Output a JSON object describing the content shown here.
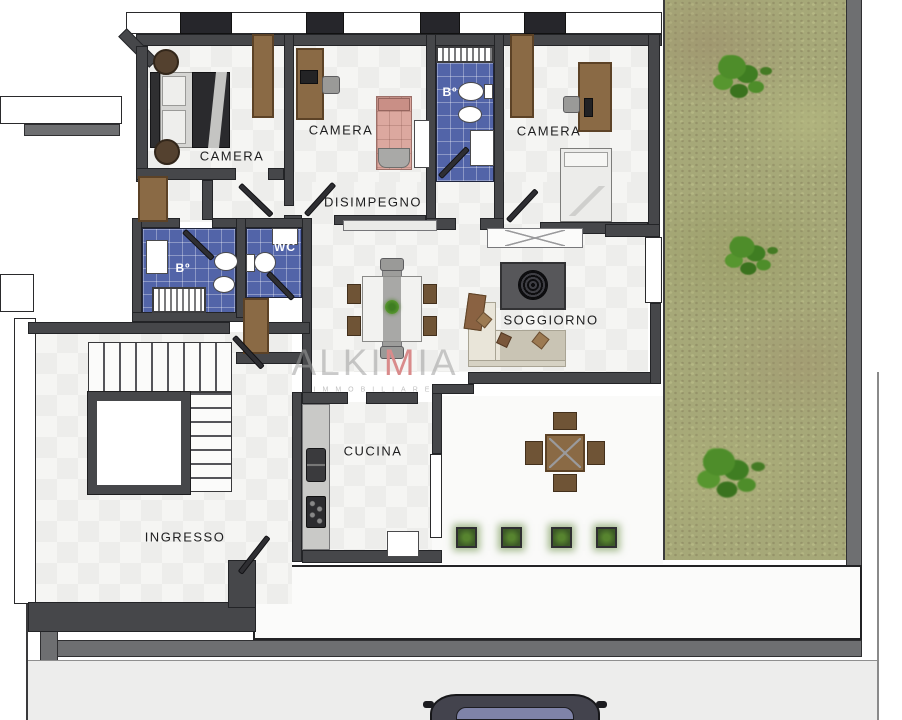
{
  "plan": {
    "type": "apartment-floor-plan",
    "rooms": {
      "camera_1": {
        "label": "CAMERA"
      },
      "camera_2": {
        "label": "CAMERA"
      },
      "camera_3": {
        "label": "CAMERA"
      },
      "bagno_1": {
        "label": "Bº"
      },
      "bagno_2": {
        "label": "Bº"
      },
      "wc": {
        "label": "WC"
      },
      "disimpegno": {
        "label": "DISIMPEGNO"
      },
      "soggiorno": {
        "label": "SOGGIORNO"
      },
      "cucina": {
        "label": "CUCINA"
      },
      "ingresso": {
        "label": "INGRESSO"
      }
    },
    "watermark": {
      "brand_pre": "ALKI",
      "brand_accent": "M",
      "brand_post": "IA",
      "subtitle": "IMMOBILIARE"
    },
    "colors": {
      "wall_dark": "#46474a",
      "wall_gray": "#6e6f71",
      "tile_blue": "#5264a8",
      "wood_brown": "#8a6a45",
      "garden_green": "#a6a878",
      "shrub_green": "#4a8a28",
      "sofa_cream": "#e9e5d9",
      "rug_gray": "#57575a",
      "accent_red": "#d98b8b"
    }
  }
}
